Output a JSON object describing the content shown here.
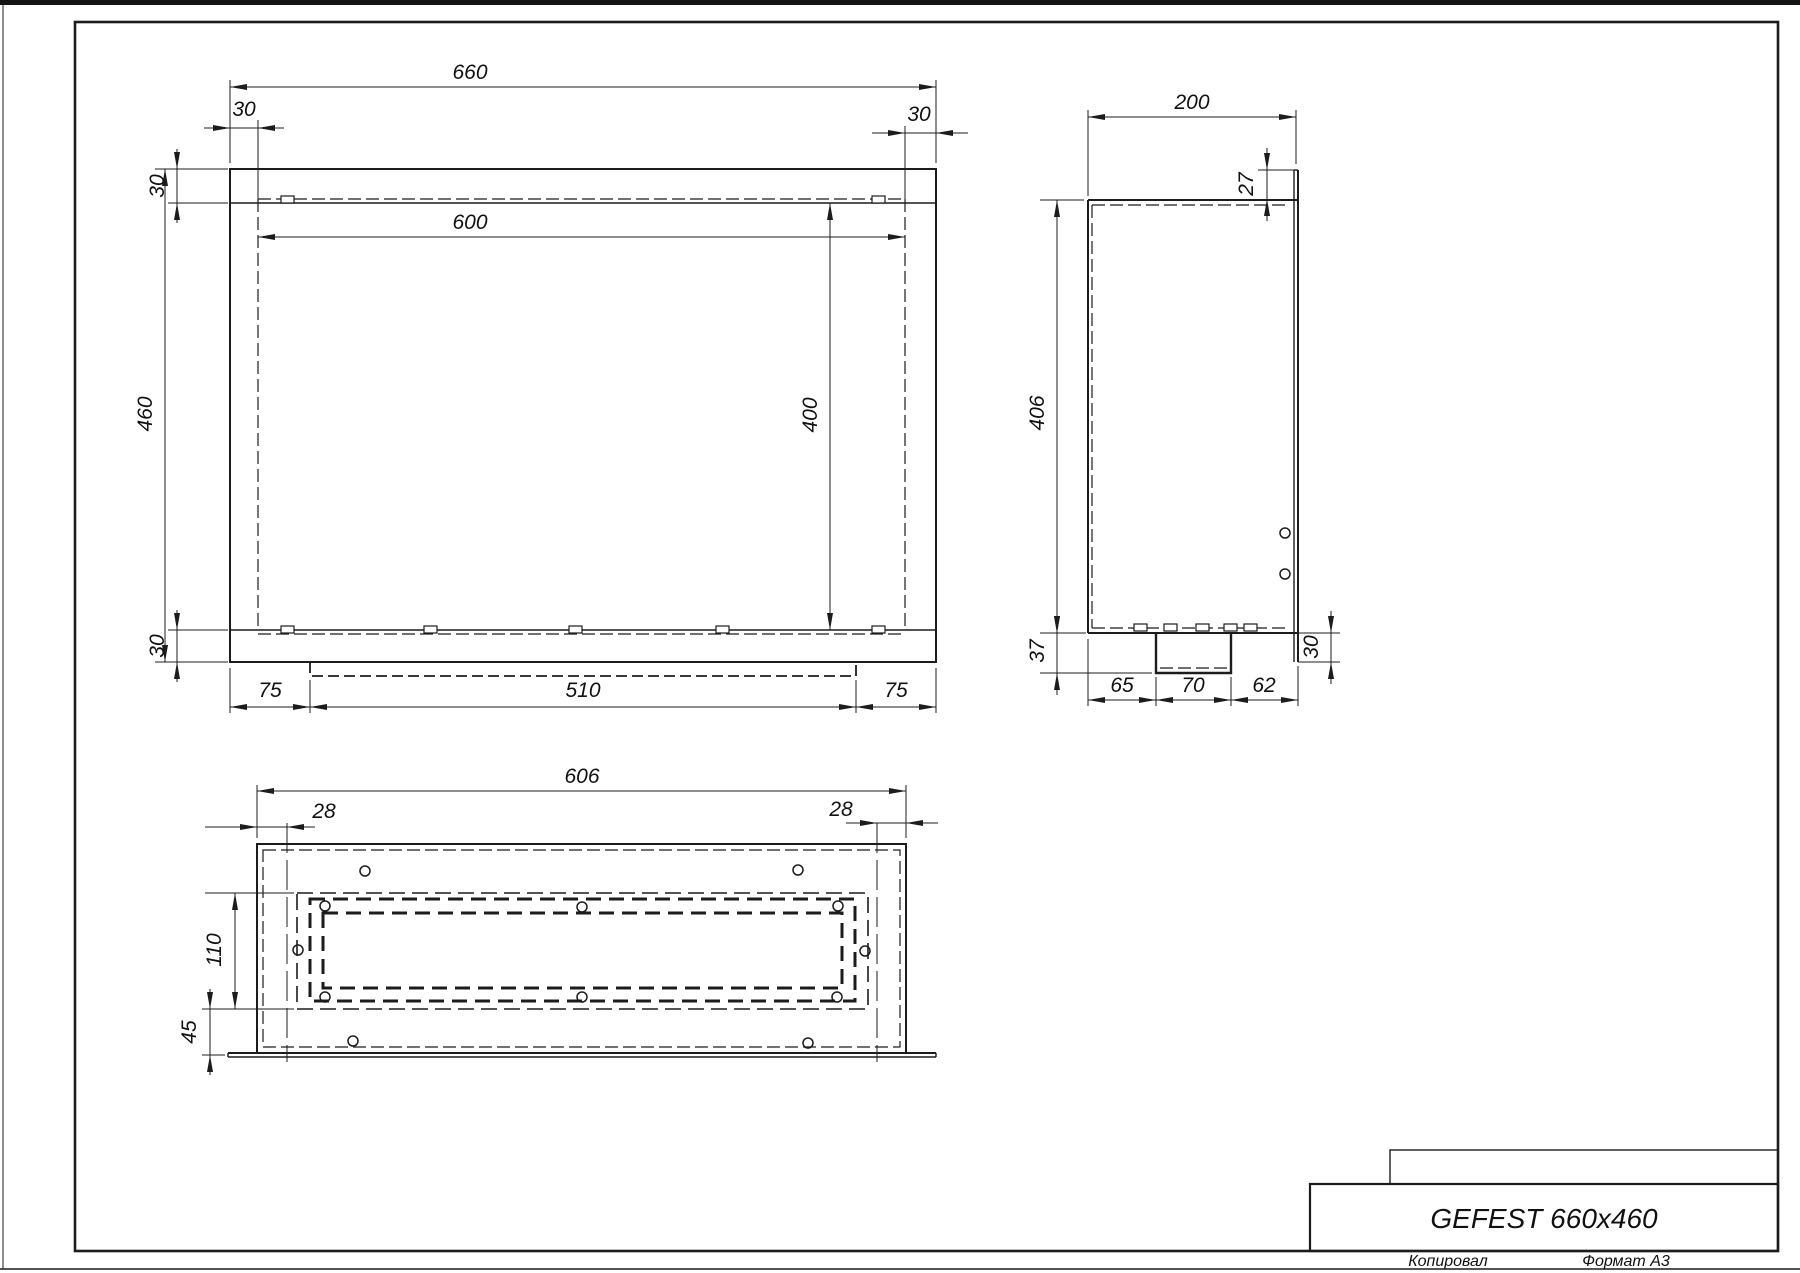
{
  "front_view": {
    "total_width": "660",
    "left_offset": "30",
    "right_offset": "30",
    "inner_width": "600",
    "total_height": "460",
    "top_offset": "30",
    "inner_height": "400",
    "bottom_offset": "30",
    "bottom_left_margin": "75",
    "bottom_opening": "510",
    "bottom_right_margin": "75"
  },
  "side_view": {
    "total_depth": "200",
    "top_lip": "27",
    "inner_height": "406",
    "bottom_step": "37",
    "bottom_left": "65",
    "bottom_center": "70",
    "bottom_right": "62",
    "right_drop": "30"
  },
  "bottom_view": {
    "total_width": "606",
    "left_offset": "28",
    "right_offset": "28",
    "slot_height": "110",
    "flange_offset": "45"
  },
  "title_block": {
    "title": "GEFEST 660x460",
    "copied_label": "Копировал",
    "format_label": "Формат A3"
  }
}
